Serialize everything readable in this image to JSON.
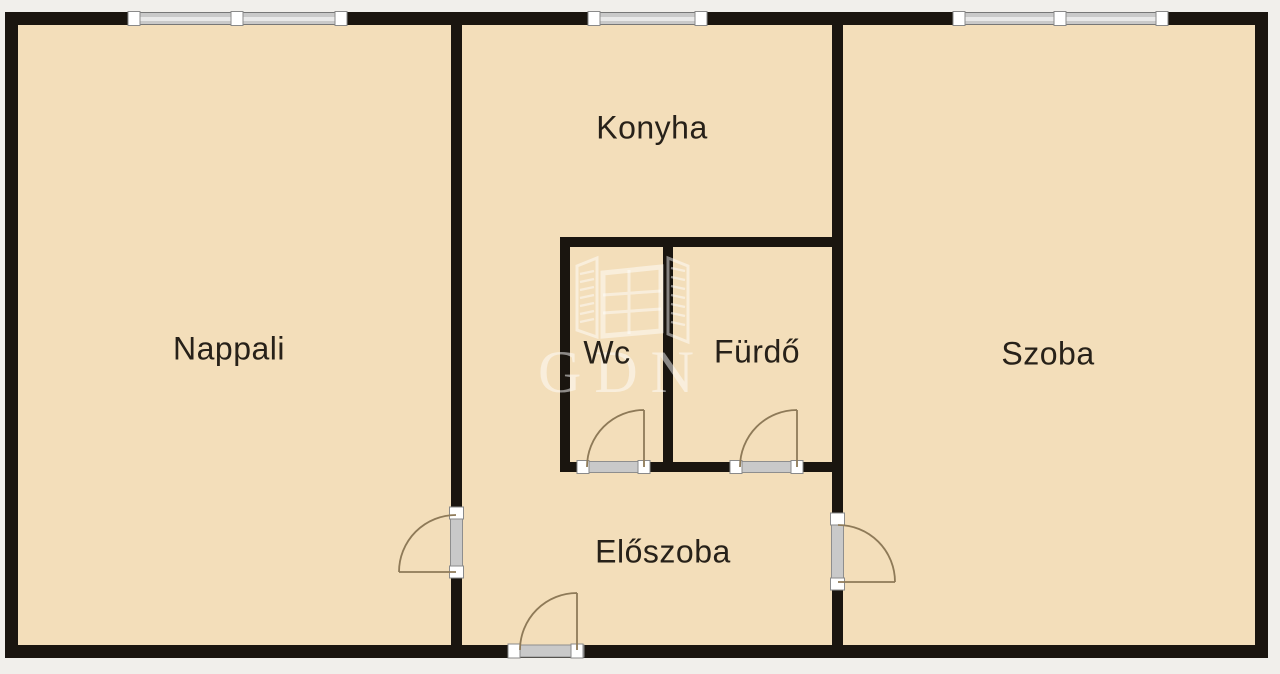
{
  "title": "Apartment floor plan",
  "rooms": [
    {
      "id": "nappali",
      "label": "Nappali"
    },
    {
      "id": "konyha",
      "label": "Konyha"
    },
    {
      "id": "wc",
      "label": "Wc"
    },
    {
      "id": "furdo",
      "label": "Fürdő"
    },
    {
      "id": "szoba",
      "label": "Szoba"
    },
    {
      "id": "eloszoba",
      "label": "Előszoba"
    }
  ],
  "watermark": {
    "text": "GDN",
    "logo": "open-window-logo"
  },
  "features": {
    "windows": 3,
    "door_swings": 5,
    "entrance_side": "bottom"
  },
  "colors": {
    "bg": "#f1efeb",
    "floor": "#f3deba",
    "wall": "#1a150f",
    "door": "#8e7a58",
    "bar": "#c9c9c9",
    "barlight": "#e9e9e9",
    "frame": "#777777",
    "cap": "#ffffff",
    "watermark": "#ffffff",
    "label": "#272119"
  }
}
